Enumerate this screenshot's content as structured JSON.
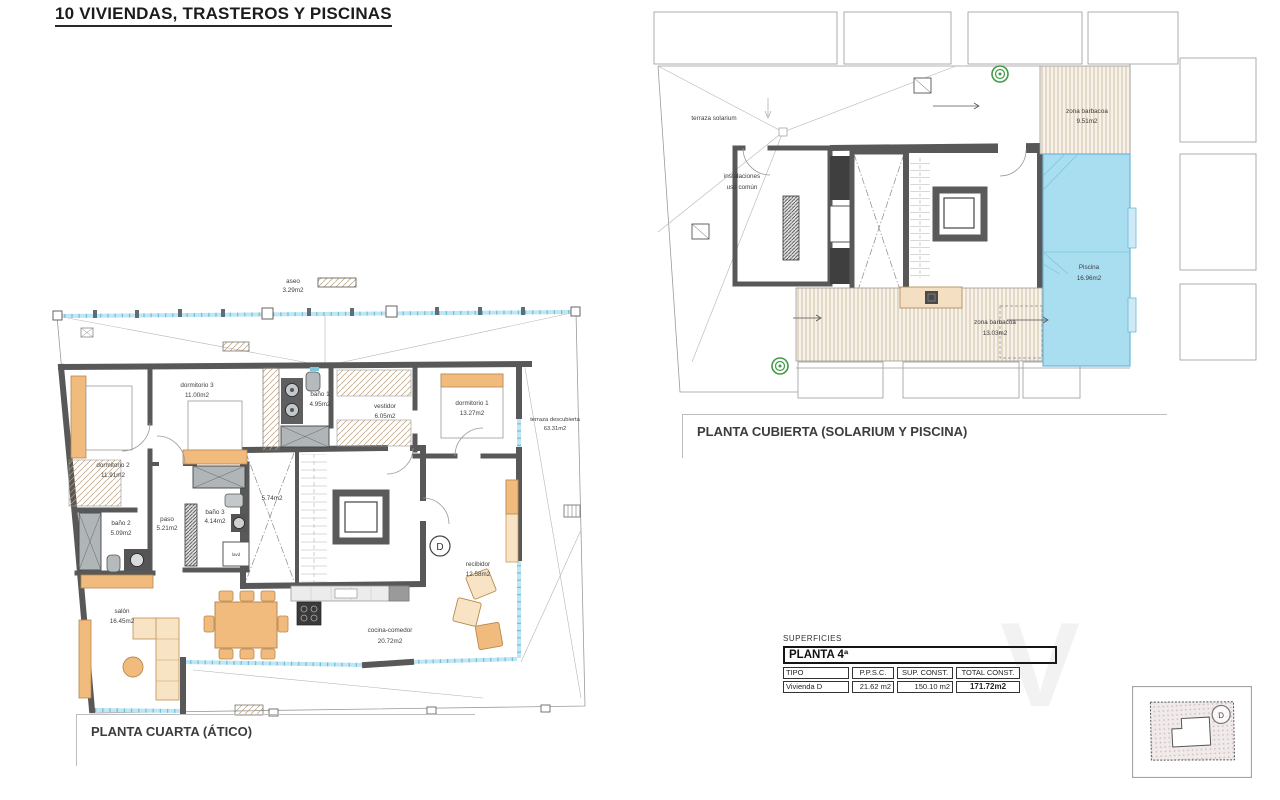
{
  "page": {
    "title": "10 VIVIENDAS, TRASTEROS Y PISCINAS",
    "watermark": "V"
  },
  "plans": {
    "atico": {
      "caption": "PLANTA CUARTA (ÁTICO)",
      "unit_letter": "D",
      "small_labels": {
        "laundry": "lavd"
      },
      "rooms": [
        {
          "name": "aseo",
          "area": "3.29m2"
        },
        {
          "name": "dormitorio 3",
          "area": "11.00m2"
        },
        {
          "name": "baño 1",
          "area": "4.95m2"
        },
        {
          "name": "vestidor",
          "area": "6.05m2"
        },
        {
          "name": "dormitorio 1",
          "area": "13.27m2"
        },
        {
          "name": "terraza descubierta",
          "area": "63.31m2"
        },
        {
          "name": "dormitorio 2",
          "area": "11.91m2"
        },
        {
          "name": "paso",
          "area": "5.21m2"
        },
        {
          "name": "baño 3",
          "area": "4.14m2"
        },
        {
          "name": "baño 2",
          "area": "5.09m2"
        },
        {
          "area": "5.74m2"
        },
        {
          "name": "salón",
          "area": "16.45m2"
        },
        {
          "name": "cocina-comedor",
          "area": "20.72m2"
        },
        {
          "name": "recibidor",
          "area": "12.58m2"
        }
      ]
    },
    "cubierta": {
      "caption": "PLANTA CUBIERTA (SOLARIUM Y PISCINA)",
      "rooms": [
        {
          "name": "terraza solarium"
        },
        {
          "line1": "instalaciones",
          "line2": "uso común"
        },
        {
          "name": "zona barbacoa",
          "area": "9.51m2"
        },
        {
          "name": "Piscina",
          "area": "16.96m2"
        },
        {
          "name": "zona barbacoa",
          "area": "13.03m2"
        }
      ]
    }
  },
  "summary": {
    "heading": "SUPERFICIES",
    "floor": "PLANTA 4ª",
    "columns": [
      "TIPO",
      "P.P.S.C.",
      "SUP. CONST.",
      "TOTAL CONST."
    ],
    "row": {
      "tipo": "Vivienda D",
      "ppsc": "21.62 m2",
      "sup": "150.10 m2",
      "total": "171.72m2"
    }
  },
  "keyplan": {
    "unit_letter": "D"
  },
  "colors": {
    "wall": "#585858",
    "glass": "#a6d9ea",
    "water": "#a9ddf0",
    "furniture": "#f0bb7d",
    "furniture_light": "#f8e3c4",
    "hatch": "#c9b598",
    "green": "#3f9b45"
  }
}
